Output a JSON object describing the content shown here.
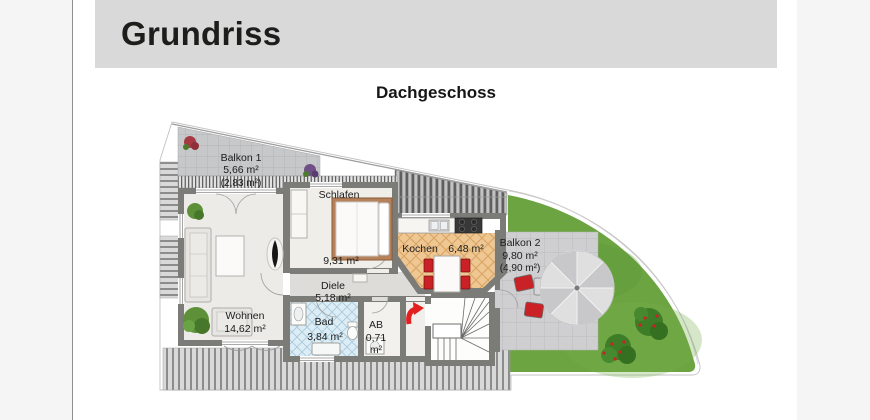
{
  "header": {
    "title": "Grundriss",
    "bar_color": "#d9d9d9"
  },
  "plan": {
    "title": "Dachgeschoss",
    "rooms": [
      {
        "id": "balkon1",
        "name": "Balkon 1",
        "area": "5,66 m²",
        "area_secondary": "(2,83 m²)"
      },
      {
        "id": "schlafen",
        "name": "Schlafen",
        "area": "9,31 m²"
      },
      {
        "id": "kochen",
        "name": "Kochen",
        "area": "6,48 m²"
      },
      {
        "id": "balkon2",
        "name": "Balkon 2",
        "area": "9,80 m²",
        "area_secondary": "(4,90 m²)"
      },
      {
        "id": "diele",
        "name": "Diele",
        "area": "5,18 m²"
      },
      {
        "id": "wohnen",
        "name": "Wohnen",
        "area": "14,62 m²"
      },
      {
        "id": "bad",
        "name": "Bad",
        "area": "3,84 m²"
      },
      {
        "id": "ab",
        "name": "AB",
        "area": "0,71",
        "area_unit": "m²"
      }
    ],
    "colors": {
      "wall": "#7b7b78",
      "floor": "#edebe7",
      "balcony_tiles": "#c7c8ca",
      "kitchen_tiles": "#efc793",
      "bath_tiles": "#ddedf5",
      "hall_floor": "#dddcd9",
      "lawn": "#6ba441",
      "terrace": "#cfcfd1",
      "accent_red": "#c92125"
    }
  }
}
